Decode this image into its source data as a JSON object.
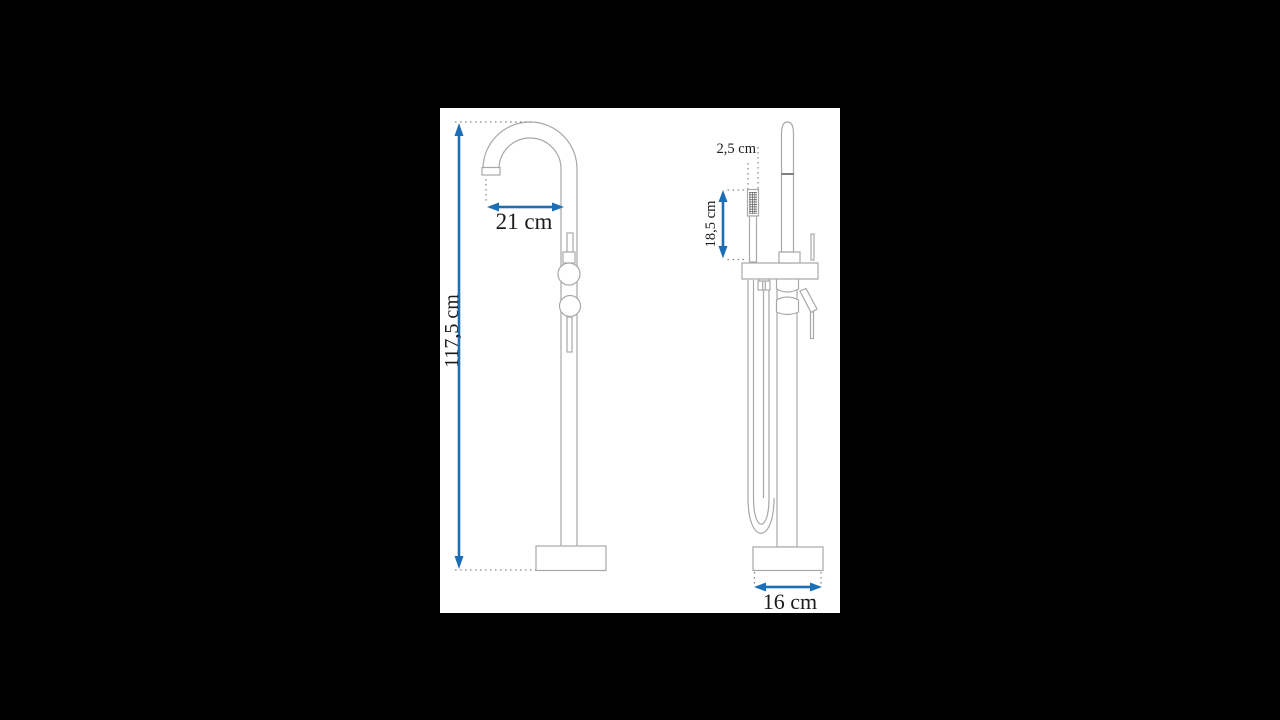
{
  "canvas": {
    "width": 1280,
    "height": 720,
    "background": "#000000"
  },
  "panel": {
    "background": "#ffffff"
  },
  "diagram": {
    "type": "technical-dimension-drawing",
    "subject": "freestanding bathtub mixer tap with hand shower",
    "views": [
      {
        "id": "front-view",
        "description": "front view: gooseneck spout, two round knobs, round base"
      },
      {
        "id": "side-view",
        "description": "side view: hand shower, mixer lever, hose loop, round base"
      }
    ],
    "colors": {
      "outline": "#a8a8a8",
      "detail_line": "#4a4a4a",
      "dotted_reference": "#8a8a8a",
      "dimension_arrow": "#1d6eb5",
      "label_text": "#1c1c1c"
    },
    "dimensions": [
      {
        "id": "total-height",
        "label": "117,5 cm",
        "orientation": "vertical",
        "view": "front-view"
      },
      {
        "id": "spout-reach",
        "label": "21 cm",
        "orientation": "horizontal",
        "view": "front-view"
      },
      {
        "id": "hand-shower-width",
        "label": "2,5 cm",
        "orientation": "horizontal",
        "view": "side-view"
      },
      {
        "id": "hand-shower-length",
        "label": "18,5 cm",
        "orientation": "vertical",
        "view": "side-view"
      },
      {
        "id": "base-diameter",
        "label": "16 cm",
        "orientation": "horizontal",
        "view": "side-view"
      }
    ]
  }
}
